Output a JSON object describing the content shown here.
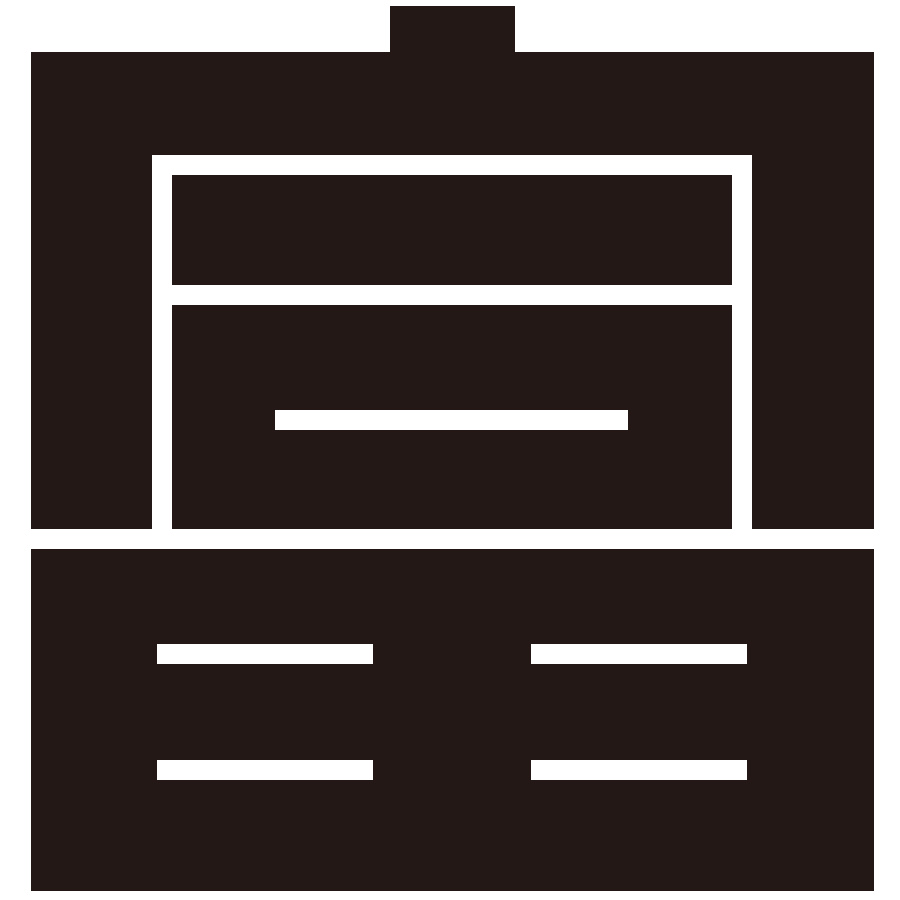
{
  "icon": {
    "name": "storage-chest-icon",
    "parts": {
      "knob": "lid-knob",
      "upper": "chest-lid-box",
      "frame": "open-lid-frame-cutout",
      "lid_panel": "lid-panel",
      "front_panel": "chest-front-panel",
      "handle_slot": "front-handle-slot",
      "lower": "lower-cabinet-box",
      "bars": [
        "handle-bar-top-left",
        "handle-bar-top-right",
        "handle-bar-bottom-left",
        "handle-bar-bottom-right"
      ]
    },
    "colors": {
      "foreground": "#231815",
      "background": "#ffffff"
    }
  }
}
